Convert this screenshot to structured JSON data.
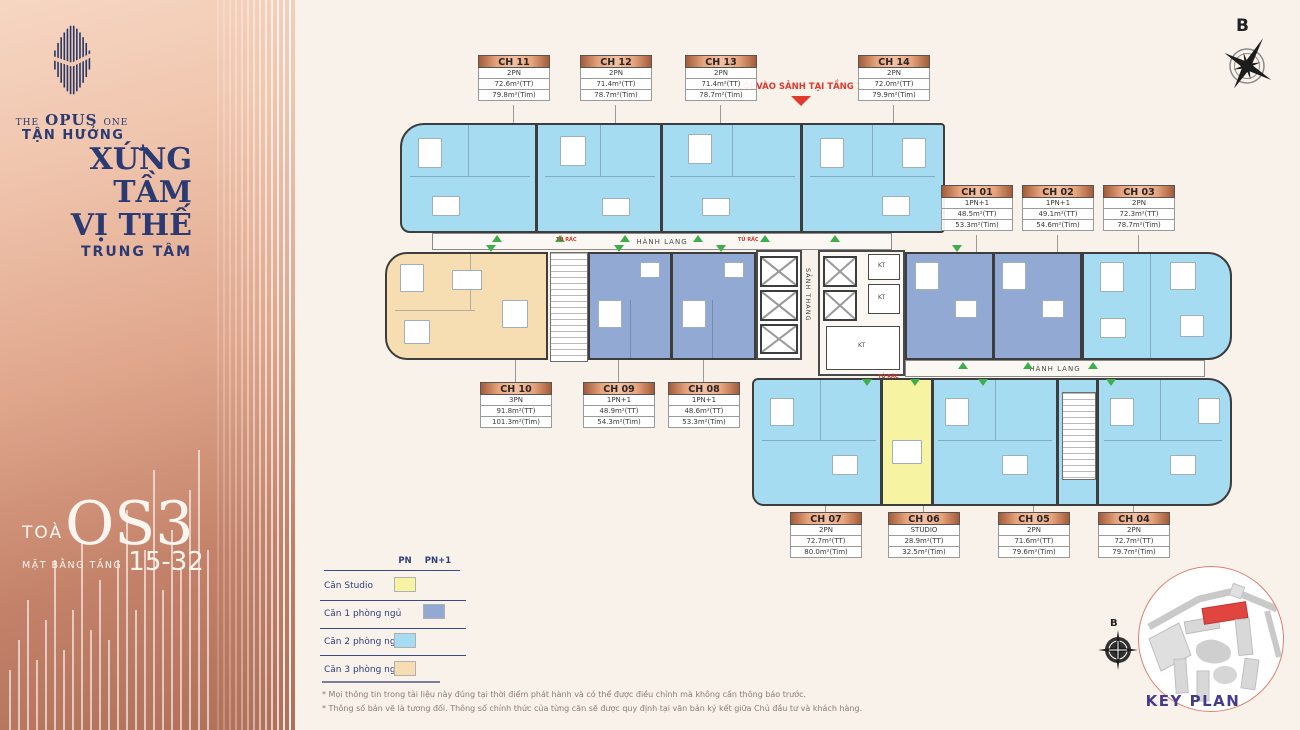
{
  "sidebar": {
    "brand_the": "THE",
    "brand_opus": "OPUS",
    "brand_one": "ONE",
    "tagline1": "TẬN HƯỞNG",
    "tagline2": "XỨNG TẦM",
    "tagline3": "VỊ THẾ",
    "tagline4": "TRUNG TÂM",
    "tower_prefix": "TOÀ",
    "tower_name": "OS3",
    "floor_label": "MẶT BẰNG TẦNG",
    "floor_range": "15-32"
  },
  "compass": {
    "north": "B"
  },
  "plan": {
    "entry": "LỐI VÀO SẢNH TẠI TẦNG 1",
    "corridor": "HÀNH LANG",
    "lobby": "SẢNH THANG",
    "shaft": "KT",
    "trash": "TỦ RÁC"
  },
  "units": [
    {
      "id": "CH 11",
      "type": "2PN",
      "area_tt": "72.6m²(TT)",
      "area_tim": "79.8m²(Tim)"
    },
    {
      "id": "CH 12",
      "type": "2PN",
      "area_tt": "71.4m²(TT)",
      "area_tim": "78.7m²(Tim)"
    },
    {
      "id": "CH 13",
      "type": "2PN",
      "area_tt": "71.4m²(TT)",
      "area_tim": "78.7m²(Tim)"
    },
    {
      "id": "CH 14",
      "type": "2PN",
      "area_tt": "72.0m²(TT)",
      "area_tim": "79.9m²(Tim)"
    },
    {
      "id": "CH 01",
      "type": "1PN+1",
      "area_tt": "48.5m²(TT)",
      "area_tim": "53.3m²(Tim)"
    },
    {
      "id": "CH 02",
      "type": "1PN+1",
      "area_tt": "49.1m²(TT)",
      "area_tim": "54.6m²(Tim)"
    },
    {
      "id": "CH 03",
      "type": "2PN",
      "area_tt": "72.3m²(TT)",
      "area_tim": "78.7m²(Tim)"
    },
    {
      "id": "CH 10",
      "type": "3PN",
      "area_tt": "91.8m²(TT)",
      "area_tim": "101.3m²(Tim)"
    },
    {
      "id": "CH 09",
      "type": "1PN+1",
      "area_tt": "48.9m²(TT)",
      "area_tim": "54.3m²(Tim)"
    },
    {
      "id": "CH 08",
      "type": "1PN+1",
      "area_tt": "48.6m²(TT)",
      "area_tim": "53.3m²(Tim)"
    },
    {
      "id": "CH 07",
      "type": "2PN",
      "area_tt": "72.7m²(TT)",
      "area_tim": "80.0m²(Tim)"
    },
    {
      "id": "CH 06",
      "type": "STUDIO",
      "area_tt": "28.9m²(TT)",
      "area_tim": "32.5m²(Tim)"
    },
    {
      "id": "CH 05",
      "type": "2PN",
      "area_tt": "71.6m²(TT)",
      "area_tim": "79.6m²(Tim)"
    },
    {
      "id": "CH 04",
      "type": "2PN",
      "area_tt": "72.7m²(TT)",
      "area_tim": "79.7m²(Tim)"
    }
  ],
  "legend": {
    "col_pn": "PN",
    "col_pn1": "PN+1",
    "rows": [
      {
        "label": "Căn Studio",
        "column": "PN",
        "color": "#F6F3A3"
      },
      {
        "label": "Căn 1 phòng ngủ",
        "column": "PN+1",
        "color": "#92A9D3"
      },
      {
        "label": "Căn 2 phòng ngủ",
        "column": "PN",
        "color": "#A5DCF2"
      },
      {
        "label": "Căn 3 phòng ngủ",
        "column": "PN",
        "color": "#F6DEB2"
      }
    ]
  },
  "notes": [
    "*  Mọi thông tin trong tài liệu này đúng tại thời điểm phát hành và có thể được điều chỉnh mà không cần thông báo trước.",
    "*  Thông số bản vẽ là tương đối. Thông số chính thức của từng căn sẽ được quy định tại văn bản ký kết giữa Chủ đầu tư và khách hàng."
  ],
  "keyplan": {
    "label": "KEY PLAN",
    "north": "B"
  },
  "colors": {
    "studio": "#F6F3A3",
    "one_bedroom": "#92A9D3",
    "two_bedroom": "#A5DCF2",
    "three_bedroom": "#F6DEB2",
    "brand_navy": "#2B3A72",
    "sidebar_top": "#F6D6C2",
    "sidebar_bottom": "#B06F58",
    "entry_red": "#E0392E",
    "marker_green": "#3DAE4A",
    "label_header": "#E8A47C",
    "background": "#F8F2EB"
  }
}
